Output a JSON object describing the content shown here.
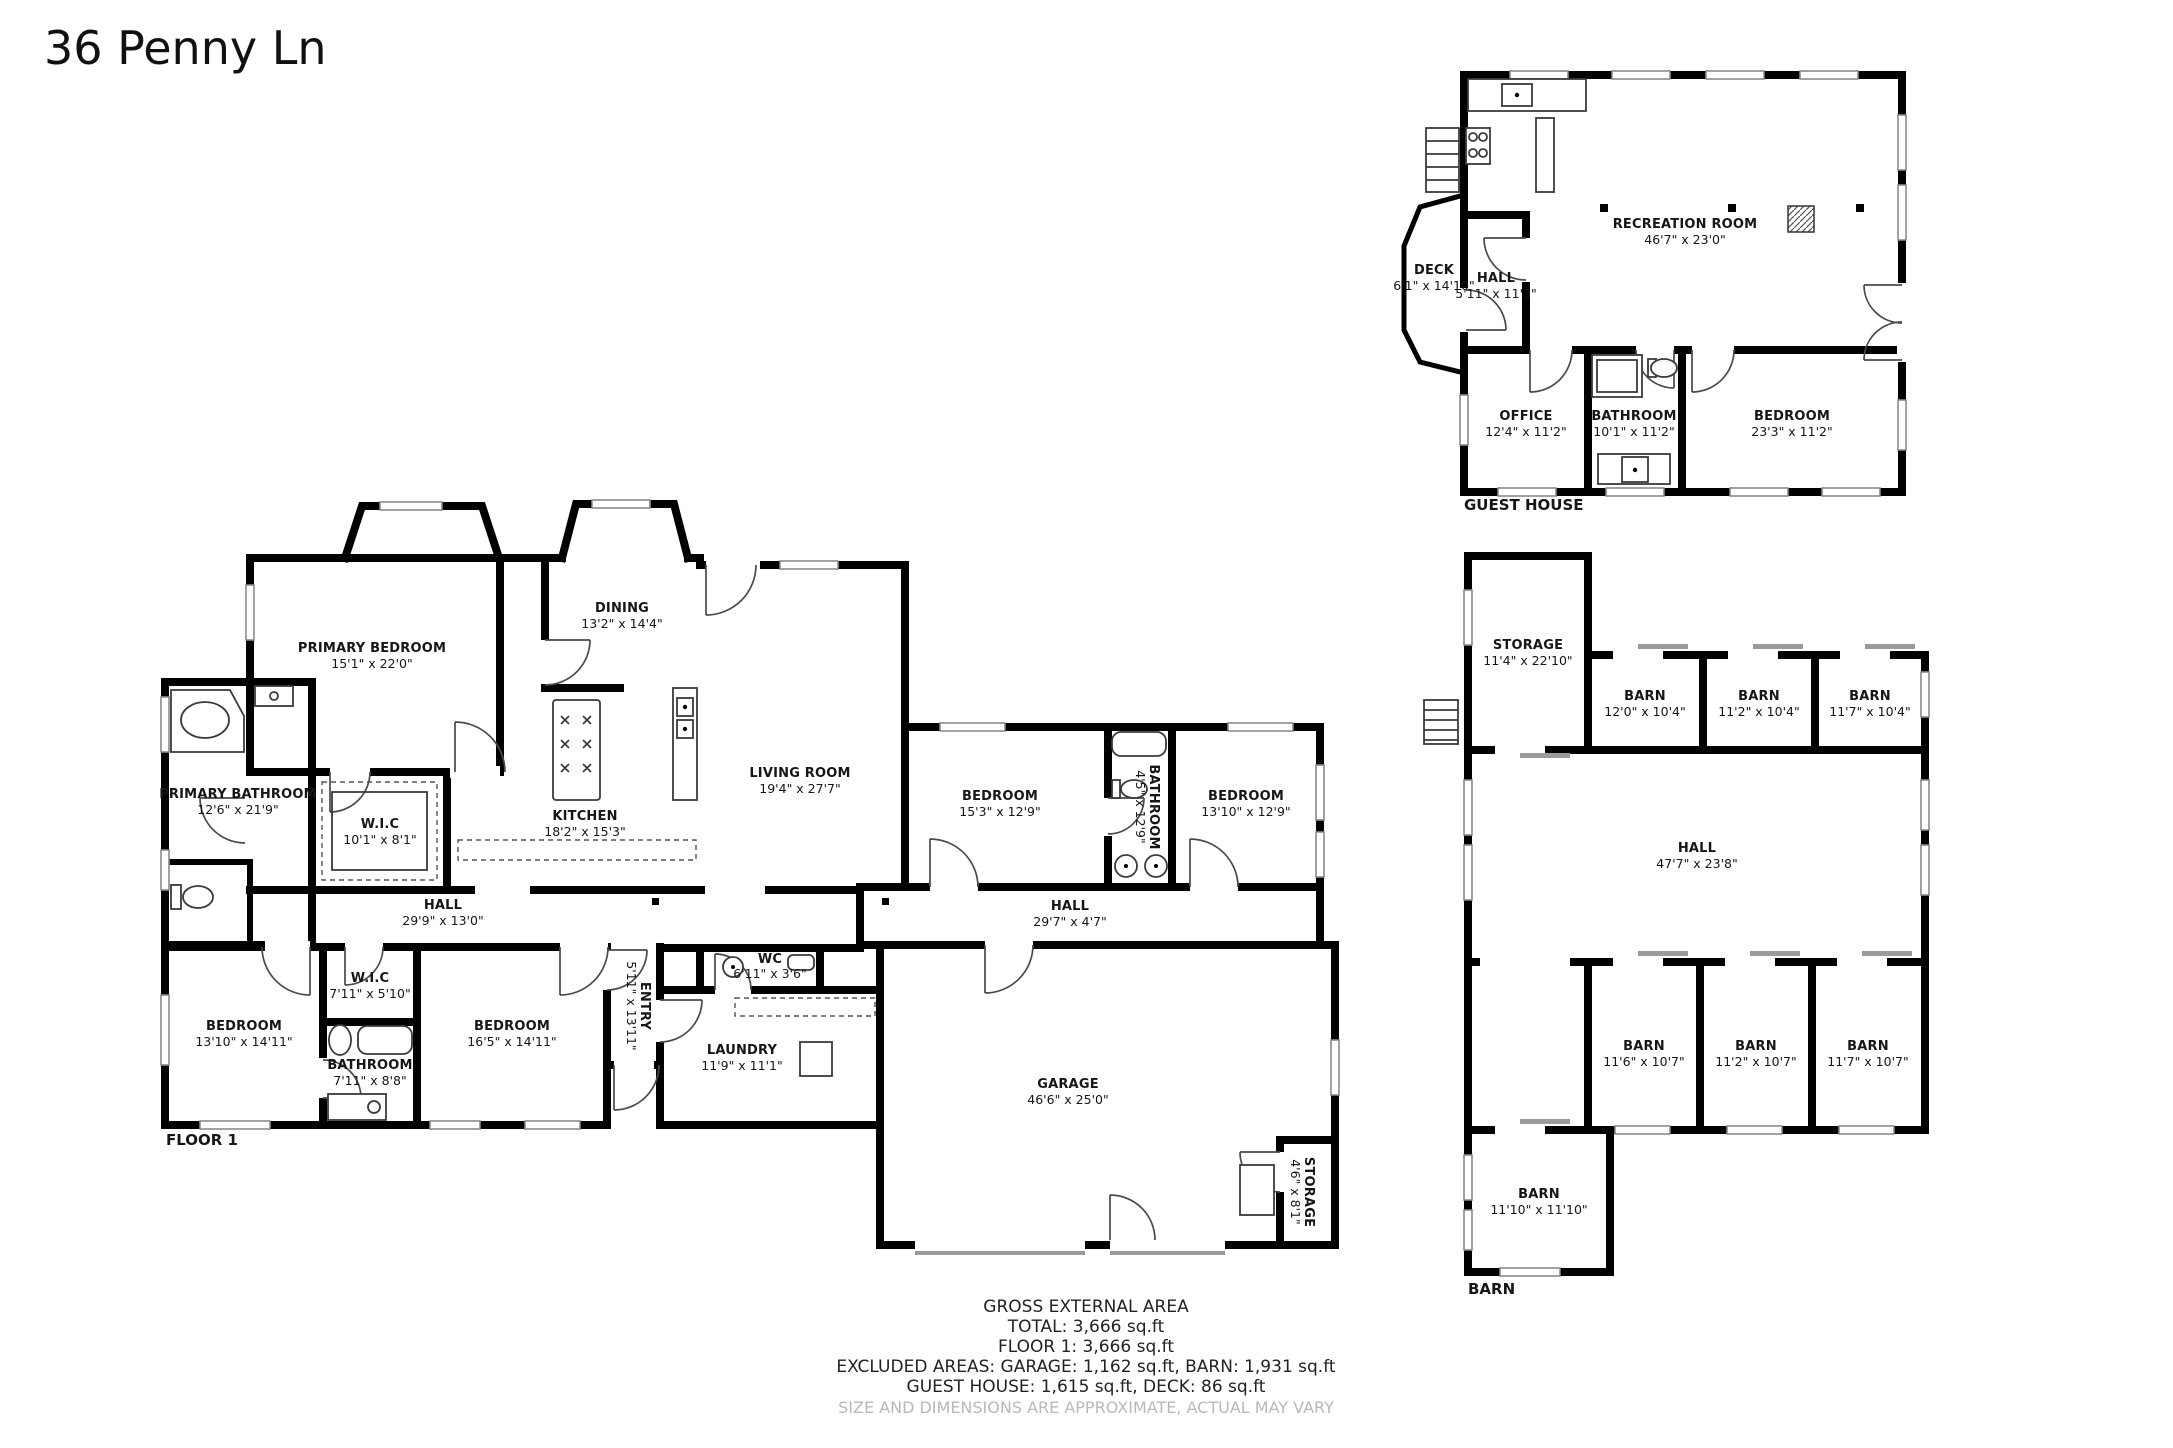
{
  "title": "36 Penny Ln",
  "floor1": {
    "caption": "FLOOR 1",
    "primary_bedroom": {
      "label": "PRIMARY BEDROOM",
      "dims": "15'1\" x 22'0\""
    },
    "primary_bathroom": {
      "label": "PRIMARY BATHROOM",
      "dims": "12'6\" x 21'9\""
    },
    "wic": {
      "label": "W.I.C",
      "dims": "10'1\" x 8'1\""
    },
    "dining": {
      "label": "DINING",
      "dims": "13'2\" x 14'4\""
    },
    "kitchen": {
      "label": "KITCHEN",
      "dims": "18'2\" x 15'3\""
    },
    "living_room": {
      "label": "LIVING ROOM",
      "dims": "19'4\" x 27'7\""
    },
    "bedroom_right1": {
      "label": "BEDROOM",
      "dims": "15'3\" x 12'9\""
    },
    "bathroom_right": {
      "label": "BATHROOM",
      "dims": "4'5\" x 12'9\""
    },
    "bedroom_right2": {
      "label": "BEDROOM",
      "dims": "13'10\" x 12'9\""
    },
    "hall_main": {
      "label": "HALL",
      "dims": "29'9\" x 13'0\""
    },
    "hall_right": {
      "label": "HALL",
      "dims": "29'7\" x 4'7\""
    },
    "bedroom_left": {
      "label": "BEDROOM",
      "dims": "13'10\" x 14'11\""
    },
    "wic_small": {
      "label": "W.I.C",
      "dims": "7'11\" x 5'10\""
    },
    "bathroom_small": {
      "label": "BATHROOM",
      "dims": "7'11\" x 8'8\""
    },
    "bedroom_mid": {
      "label": "BEDROOM",
      "dims": "16'5\" x 14'11\""
    },
    "entry": {
      "label": "ENTRY",
      "dims": "5'11\" x 13'11\""
    },
    "wc": {
      "label": "WC",
      "dims": "6'11\" x 3'6\""
    },
    "laundry": {
      "label": "LAUNDRY",
      "dims": "11'9\" x 11'1\""
    },
    "garage": {
      "label": "GARAGE",
      "dims": "46'6\" x 25'0\""
    },
    "storage": {
      "label": "STORAGE",
      "dims": "4'6\" x 8'1\""
    }
  },
  "guest_house": {
    "caption": "GUEST HOUSE",
    "recreation_room": {
      "label": "RECREATION ROOM",
      "dims": "46'7\" x 23'0\""
    },
    "deck": {
      "label": "DECK",
      "dims": "6'1\" x 14'10\""
    },
    "hall": {
      "label": "HALL",
      "dims": "5'11\" x 11'3\""
    },
    "office": {
      "label": "OFFICE",
      "dims": "12'4\" x 11'2\""
    },
    "bathroom": {
      "label": "BATHROOM",
      "dims": "10'1\" x 11'2\""
    },
    "bedroom": {
      "label": "BEDROOM",
      "dims": "23'3\" x 11'2\""
    }
  },
  "barn": {
    "caption": "BARN",
    "storage": {
      "label": "STORAGE",
      "dims": "11'4\" x 22'10\""
    },
    "barn_t1": {
      "label": "BARN",
      "dims": "12'0\" x 10'4\""
    },
    "barn_t2": {
      "label": "BARN",
      "dims": "11'2\" x 10'4\""
    },
    "barn_t3": {
      "label": "BARN",
      "dims": "11'7\" x 10'4\""
    },
    "hall": {
      "label": "HALL",
      "dims": "47'7\" x 23'8\""
    },
    "barn_b1": {
      "label": "BARN",
      "dims": "11'6\" x 10'7\""
    },
    "barn_b2": {
      "label": "BARN",
      "dims": "11'2\" x 10'7\""
    },
    "barn_b3": {
      "label": "BARN",
      "dims": "11'7\" x 10'7\""
    },
    "barn_sw": {
      "label": "BARN",
      "dims": "11'10\" x 11'10\""
    }
  },
  "footer": {
    "line1": "GROSS EXTERNAL AREA",
    "line2": "TOTAL: 3,666 sq.ft",
    "line3": "FLOOR 1: 3,666 sq.ft",
    "line4": "EXCLUDED AREAS: GARAGE: 1,162 sq.ft, BARN: 1,931 sq.ft",
    "line5": "GUEST HOUSE: 1,615 sq.ft, DECK: 86 sq.ft",
    "disclaimer": "SIZE AND DIMENSIONS ARE APPROXIMATE, ACTUAL MAY VARY"
  }
}
